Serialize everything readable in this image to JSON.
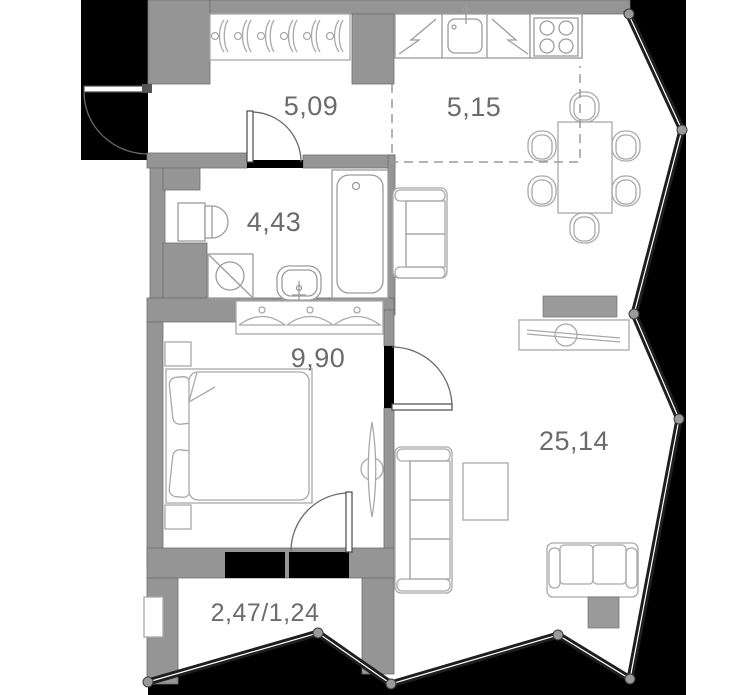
{
  "plan": {
    "type": "apartment-floor-plan",
    "rooms": {
      "hallway": {
        "area": "5,09"
      },
      "kitchen_dining": {
        "area": "5,15"
      },
      "bathroom": {
        "area": "4,43"
      },
      "bedroom": {
        "area": "9,90"
      },
      "living_room": {
        "area": "25,14"
      },
      "balcony": {
        "area": "2,47/1,24"
      }
    },
    "colors": {
      "wall": "#959595",
      "outside": "#000000",
      "label": "#6b6b6b",
      "furniture_line": "#a9a9a9",
      "zone_dash": "#9b9b9b",
      "glazing": "#1e1e1e",
      "accent_block": "#9a9a9a"
    }
  }
}
